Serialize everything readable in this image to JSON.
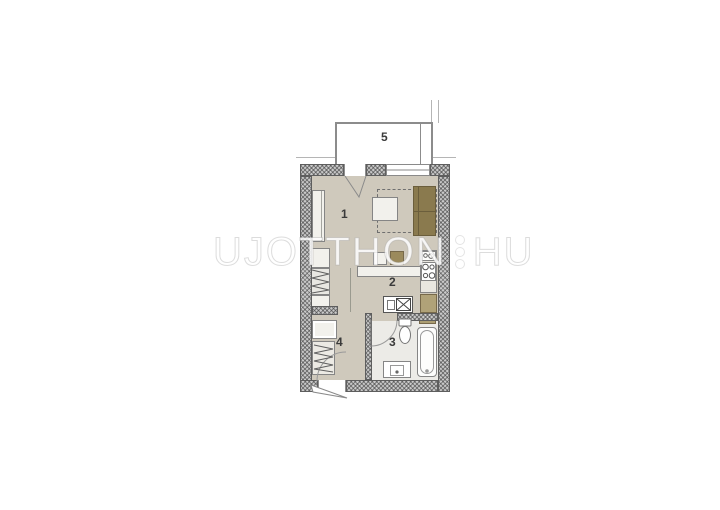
{
  "watermark": {
    "text_left": "UJOTTHON",
    "text_right": "HU"
  },
  "rooms": [
    {
      "label": "1"
    },
    {
      "label": "2"
    },
    {
      "label": "3"
    },
    {
      "label": "4"
    },
    {
      "label": "5"
    }
  ],
  "colors": {
    "floor_beige": "#cfc9bc",
    "bathroom_floor": "#ecebe7",
    "sofa_tan": "#8a7a4e",
    "cabinet_tan": "#b0a278",
    "wall_gray": "#c9c9c9",
    "line_gray": "#8a8a8a",
    "watermark_white": "#ffffff"
  }
}
